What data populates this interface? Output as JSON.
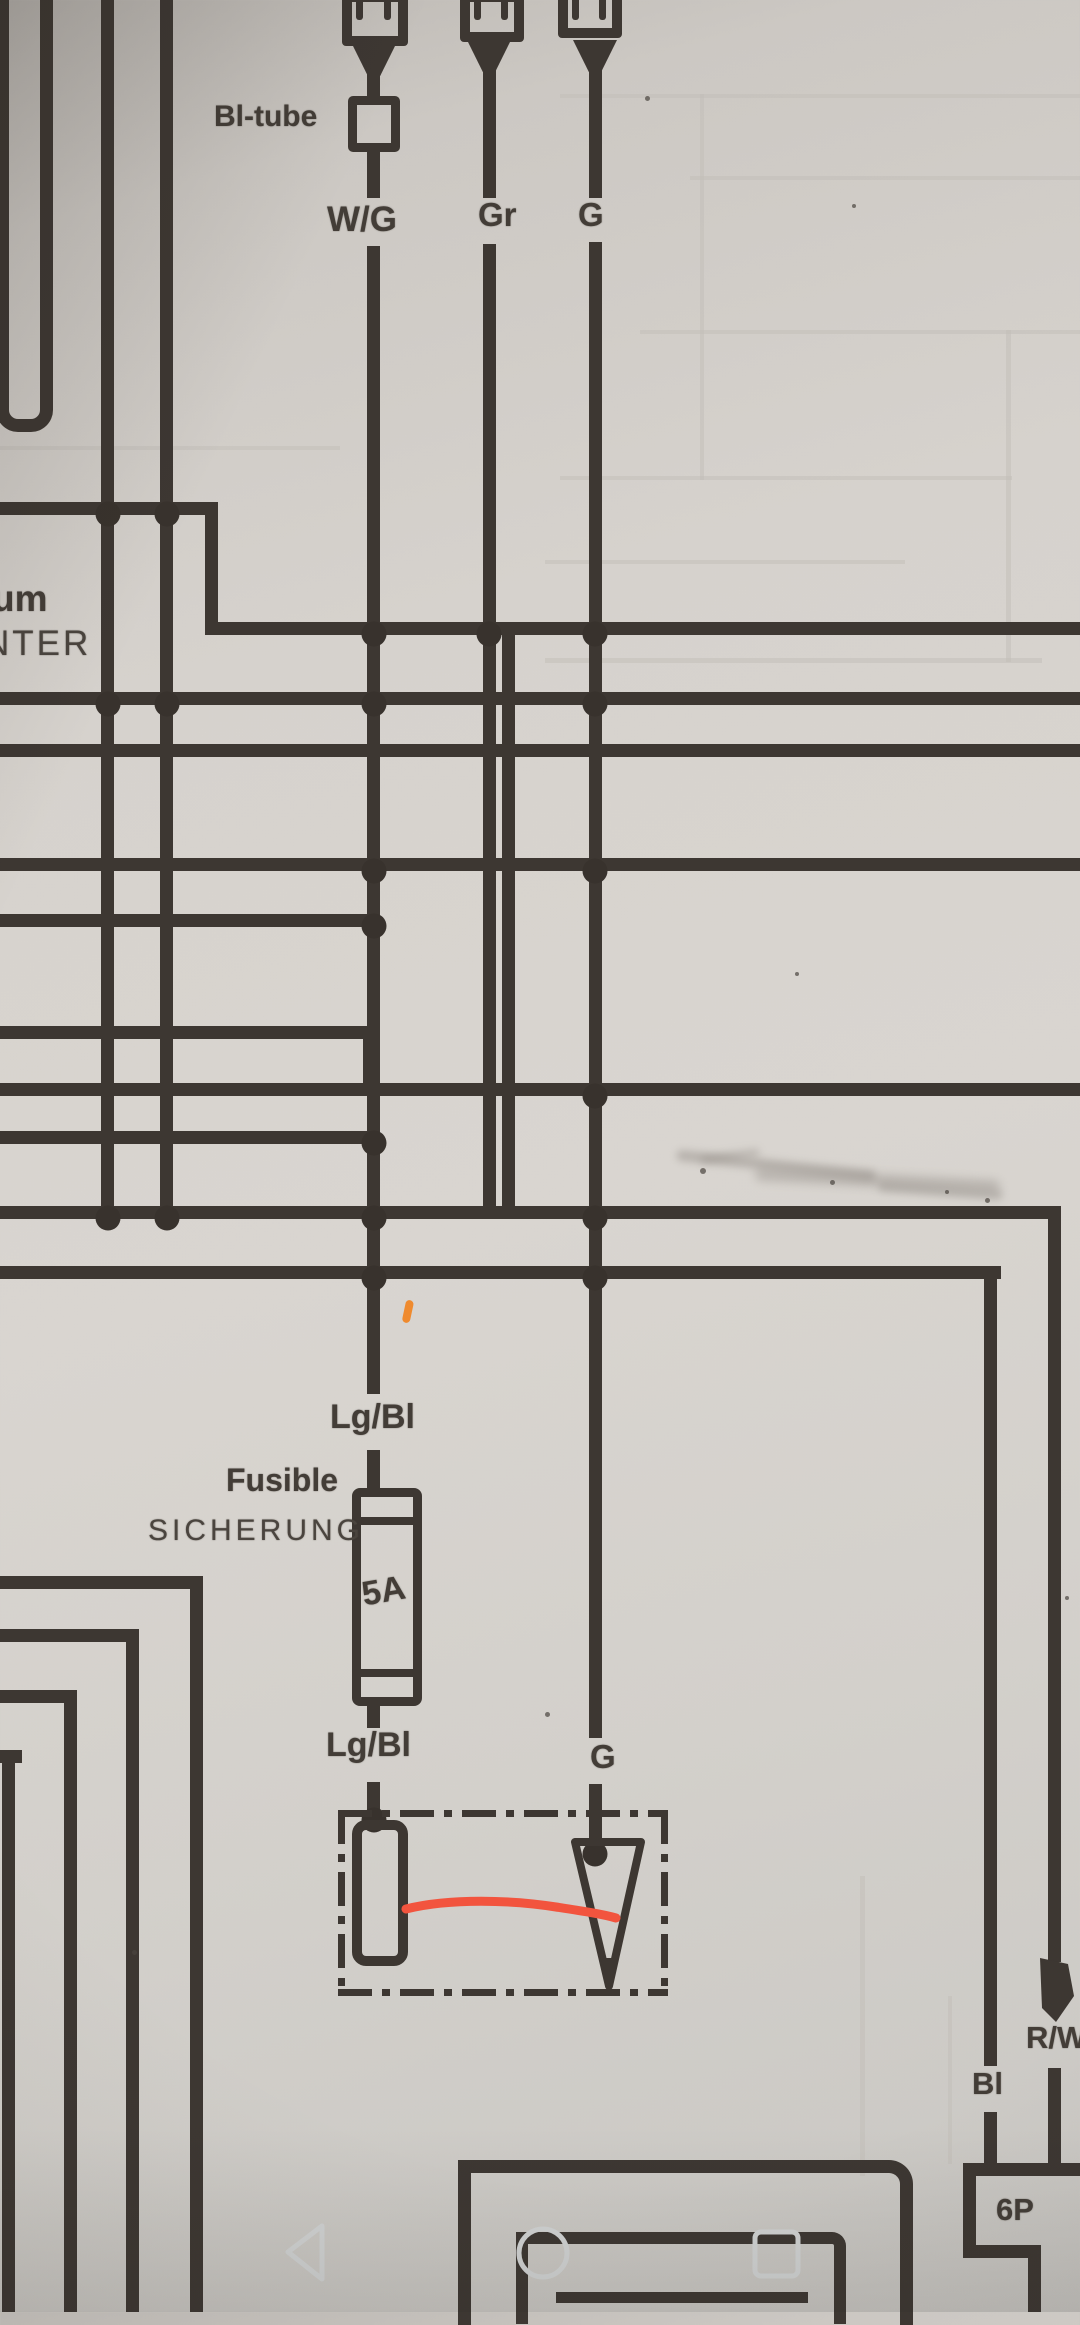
{
  "labels": {
    "bl_tube": "Bl-tube",
    "wire_wg": "W/G",
    "wire_gr": "Gr",
    "wire_g_top": "G",
    "partial_um": "um",
    "partial_nter": "NTER",
    "wire_lgbl_1": "Lg/Bl",
    "fuse_fr": "Fusible",
    "fuse_de": "SICHERUNG",
    "fuse_rating": "5A",
    "wire_lgbl_2": "Lg/Bl",
    "wire_g_mid": "G",
    "wire_bl": "Bl",
    "wire_rw": "R/W",
    "connector_6p": "6P"
  },
  "colors": {
    "ink": "#3d3732",
    "paper": "#d6d2cd",
    "red_marker": "#f2543e",
    "orange_marker": "#ef8a2e",
    "nav_icon": "#d3d5d5",
    "smudge": "#8f8983"
  },
  "nav_bar": {
    "back_icon": "back-triangle",
    "home_icon": "home-circle",
    "recents_icon": "recents-square"
  },
  "diagram": {
    "wires": [
      {
        "x": 101,
        "y": 0,
        "w": 13,
        "h": 1219,
        "n": "bus-vertical-left-1"
      },
      {
        "x": 160,
        "y": 0,
        "w": 13,
        "h": 1219,
        "n": "bus-vertical-left-2"
      },
      {
        "x": 205,
        "y": 502,
        "w": 13,
        "h": 133,
        "n": "step-vertical"
      },
      {
        "x": 0,
        "y": 502,
        "w": 218,
        "h": 13,
        "n": "bus-h-502"
      },
      {
        "x": 205,
        "y": 622,
        "w": 875,
        "h": 13,
        "n": "bus-h-628"
      },
      {
        "x": 0,
        "y": 692,
        "w": 1080,
        "h": 13,
        "n": "bus-h-698"
      },
      {
        "x": 0,
        "y": 744,
        "w": 1080,
        "h": 13,
        "n": "bus-h-750"
      },
      {
        "x": 0,
        "y": 858,
        "w": 1080,
        "h": 13,
        "n": "bus-h-865"
      },
      {
        "x": 0,
        "y": 914,
        "w": 380,
        "h": 13,
        "n": "bus-h-920"
      },
      {
        "x": 0,
        "y": 1026,
        "w": 376,
        "h": 13,
        "n": "bus-h-1032"
      },
      {
        "x": 363,
        "y": 1026,
        "w": 13,
        "h": 70,
        "n": "step-vertical-2"
      },
      {
        "x": 0,
        "y": 1083,
        "w": 1080,
        "h": 13,
        "n": "bus-h-1090"
      },
      {
        "x": 0,
        "y": 1131,
        "w": 380,
        "h": 13,
        "n": "bus-h-1137"
      },
      {
        "x": 0,
        "y": 1206,
        "w": 1061,
        "h": 13,
        "n": "bus-h-1212"
      },
      {
        "x": 0,
        "y": 1266,
        "w": 1001,
        "h": 13,
        "n": "bus-h-1272"
      },
      {
        "x": 367,
        "y": 44,
        "w": 13,
        "h": 56,
        "n": "wg-wire"
      },
      {
        "x": 367,
        "y": 148,
        "w": 13,
        "h": 50,
        "n": "wg-wire"
      },
      {
        "x": 367,
        "y": 246,
        "w": 13,
        "h": 1148,
        "n": "wg-wire"
      },
      {
        "x": 367,
        "y": 1450,
        "w": 13,
        "h": 42,
        "n": "wg-wire"
      },
      {
        "x": 367,
        "y": 1702,
        "w": 13,
        "h": 26,
        "n": "wg-wire"
      },
      {
        "x": 367,
        "y": 1782,
        "w": 13,
        "h": 46,
        "n": "wg-wire"
      },
      {
        "x": 483,
        "y": 44,
        "w": 13,
        "h": 154,
        "n": "gr-wire"
      },
      {
        "x": 483,
        "y": 244,
        "w": 13,
        "h": 975,
        "n": "gr-wire"
      },
      {
        "x": 502,
        "y": 622,
        "w": 13,
        "h": 597,
        "n": "branch-vertical"
      },
      {
        "x": 589,
        "y": 44,
        "w": 13,
        "h": 154,
        "n": "g-wire"
      },
      {
        "x": 589,
        "y": 242,
        "w": 13,
        "h": 1496,
        "n": "g-wire"
      },
      {
        "x": 589,
        "y": 1784,
        "w": 13,
        "h": 62,
        "n": "g-wire"
      },
      {
        "x": 984,
        "y": 1266,
        "w": 13,
        "h": 800,
        "n": "bl-wire"
      },
      {
        "x": 984,
        "y": 2112,
        "w": 13,
        "h": 60,
        "n": "bl-wire"
      },
      {
        "x": 1048,
        "y": 1206,
        "w": 13,
        "h": 756,
        "n": "rw-wire"
      },
      {
        "x": 1048,
        "y": 2068,
        "w": 13,
        "h": 104,
        "n": "rw-wire"
      },
      {
        "x": 0,
        "y": 1576,
        "w": 203,
        "h": 13,
        "n": "bracket-1-h"
      },
      {
        "x": 190,
        "y": 1576,
        "w": 13,
        "h": 736,
        "n": "bracket-1-v"
      },
      {
        "x": 0,
        "y": 1629,
        "w": 139,
        "h": 13,
        "n": "bracket-2-h"
      },
      {
        "x": 126,
        "y": 1629,
        "w": 13,
        "h": 683,
        "n": "bracket-2-v"
      },
      {
        "x": 0,
        "y": 1690,
        "w": 77,
        "h": 13,
        "n": "bracket-3-h"
      },
      {
        "x": 64,
        "y": 1690,
        "w": 13,
        "h": 622,
        "n": "bracket-3-v"
      },
      {
        "x": 0,
        "y": 1750,
        "w": 22,
        "h": 13,
        "n": "bracket-4-h"
      },
      {
        "x": 2,
        "y": 1750,
        "w": 13,
        "h": 562,
        "n": "bracket-4-v"
      },
      {
        "x": 963,
        "y": 2163,
        "w": 117,
        "h": 13,
        "n": "6p-box-top"
      },
      {
        "x": 963,
        "y": 2163,
        "w": 13,
        "h": 95,
        "n": "6p-box-left"
      },
      {
        "x": 963,
        "y": 2245,
        "w": 78,
        "h": 13,
        "n": "6p-box-step-h"
      },
      {
        "x": 1028,
        "y": 2245,
        "w": 13,
        "h": 67,
        "n": "6p-box-step-v"
      },
      {
        "x": 556,
        "y": 2292,
        "w": 252,
        "h": 11,
        "n": "bigbox-inner-line"
      }
    ],
    "junctions": [
      [
        108,
        508
      ],
      [
        167,
        508
      ],
      [
        374,
        628
      ],
      [
        489,
        628
      ],
      [
        595,
        628
      ],
      [
        108,
        698
      ],
      [
        167,
        698
      ],
      [
        374,
        698
      ],
      [
        595,
        698
      ],
      [
        374,
        865
      ],
      [
        595,
        865
      ],
      [
        595,
        1090
      ],
      [
        374,
        920
      ],
      [
        108,
        1212
      ],
      [
        167,
        1212
      ],
      [
        374,
        1212
      ],
      [
        595,
        1212
      ],
      [
        374,
        1272
      ],
      [
        595,
        1272
      ],
      [
        374,
        1137
      ],
      [
        374,
        1814
      ],
      [
        595,
        1848
      ]
    ],
    "ghost_lines": [
      {
        "x": 560,
        "y": 94,
        "w": 520,
        "h": 4
      },
      {
        "x": 690,
        "y": 176,
        "w": 390,
        "h": 4
      },
      {
        "x": 640,
        "y": 330,
        "w": 440,
        "h": 4
      },
      {
        "x": 560,
        "y": 476,
        "w": 452,
        "h": 4
      },
      {
        "x": 545,
        "y": 560,
        "w": 360,
        "h": 4
      },
      {
        "x": 545,
        "y": 658,
        "w": 497,
        "h": 5
      },
      {
        "x": 0,
        "y": 446,
        "w": 340,
        "h": 4
      },
      {
        "x": 700,
        "y": 94,
        "w": 4,
        "h": 386
      },
      {
        "x": 1006,
        "y": 330,
        "w": 5,
        "h": 332
      },
      {
        "x": 860,
        "y": 1876,
        "w": 5,
        "h": 300
      },
      {
        "x": 948,
        "y": 1996,
        "w": 4,
        "h": 168
      }
    ],
    "specks": [
      [
        645,
        96,
        5
      ],
      [
        852,
        204,
        4
      ],
      [
        795,
        972,
        4
      ],
      [
        545,
        1712,
        5
      ],
      [
        1065,
        1596,
        4
      ],
      [
        700,
        1168,
        6
      ],
      [
        830,
        1180,
        5
      ],
      [
        985,
        1198,
        5
      ],
      [
        945,
        1190,
        4
      ],
      [
        132,
        1950,
        5
      ]
    ],
    "smudges": [
      {
        "x": 676,
        "y": 1160,
        "w": 200,
        "h": 11,
        "r": 6,
        "b": 4,
        "o": 0.45
      },
      {
        "x": 755,
        "y": 1174,
        "w": 245,
        "h": 13,
        "r": 3,
        "b": 5,
        "o": 0.42
      },
      {
        "x": 878,
        "y": 1186,
        "w": 125,
        "h": 10,
        "r": 4,
        "b": 4,
        "o": 0.38
      },
      {
        "x": 700,
        "y": 1152,
        "w": 60,
        "h": 8,
        "r": -8,
        "b": 4,
        "o": 0.35
      }
    ],
    "dashdot_box": {
      "x": 338,
      "y": 1810,
      "w": 330,
      "h": 186
    },
    "connectors_top": [
      {
        "x": 342,
        "y": -8,
        "w": 46,
        "h": 34,
        "wire_cx": 374
      },
      {
        "x": 460,
        "y": -8,
        "w": 44,
        "h": 30,
        "wire_cx": 489
      },
      {
        "x": 558,
        "y": -10,
        "w": 44,
        "h": 30,
        "wire_cx": 595
      }
    ]
  }
}
